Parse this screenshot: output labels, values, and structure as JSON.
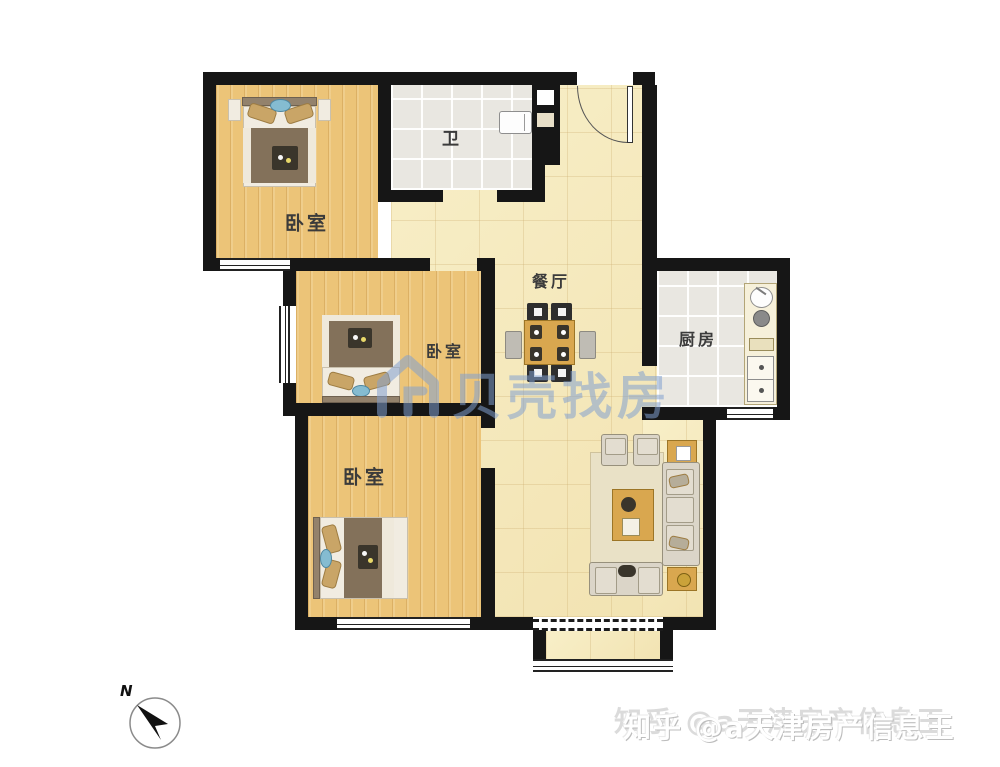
{
  "page": {
    "kind": "apartment-floor-plan"
  },
  "rooms": {
    "bedroom_top": {
      "label": "卧室"
    },
    "bathroom": {
      "label": "卫"
    },
    "dining": {
      "label": "餐厅"
    },
    "kitchen": {
      "label": "厨房"
    },
    "bedroom_middle": {
      "label": "卧室"
    },
    "bedroom_bottom": {
      "label": "卧室"
    }
  },
  "compass": {
    "north_label": "N"
  },
  "watermarks": {
    "beike_logo": "house-icon",
    "beike_text": "贝壳找房",
    "zhihu_text": "知乎 @a天津房产信息王"
  },
  "colors": {
    "wall": "#161616",
    "wood_floor": "#ecc478",
    "hall_tile": "#f6ebbf",
    "wet_tile": "#e9e7e1",
    "watermark_blue": "#82a0d0",
    "furniture_wood": "#d9a74f",
    "sofa": "#dbd5c8",
    "blanket": "#83715a"
  }
}
